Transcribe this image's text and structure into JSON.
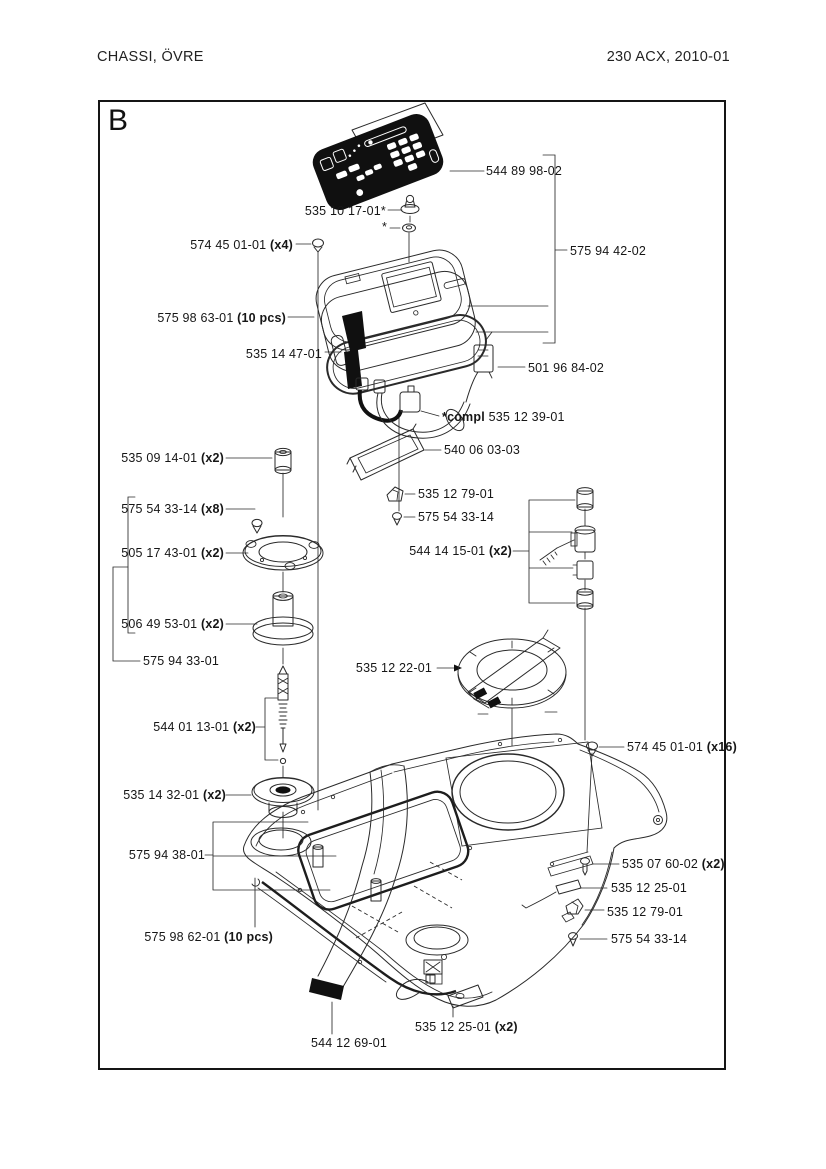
{
  "header": {
    "title": "CHASSI, ÖVRE",
    "model": "230 ACX, 2010-01"
  },
  "section": {
    "letter": "B"
  },
  "parts": [
    {
      "number": "544 89 98-02"
    },
    {
      "number": "535 10 17-01*"
    },
    {
      "number": "*"
    },
    {
      "number": "574 45 01-01",
      "qty": " (x4)"
    },
    {
      "number": "575 94 42-02"
    },
    {
      "number": "575 98 63-01",
      "qty": " (10 pcs)"
    },
    {
      "number": "535 14 47-01"
    },
    {
      "number": "501 96 84-02"
    },
    {
      "prefix": "*compl ",
      "number": "535 12 39-01"
    },
    {
      "number": "540 06 03-03"
    },
    {
      "number": "535 09 14-01",
      "qty": " (x2)"
    },
    {
      "number": "575 54 33-14",
      "qty": " (x8)"
    },
    {
      "number": "505 17 43-01",
      "qty": " (x2)"
    },
    {
      "number": "506 49 53-01",
      "qty": " (x2)"
    },
    {
      "number": "575 94 33-01"
    },
    {
      "number": "535 12 79-01"
    },
    {
      "number": "575 54 33-14"
    },
    {
      "number": "544 14 15-01",
      "qty": " (x2)"
    },
    {
      "number": "535 12 22-01"
    },
    {
      "number": "544 01 13-01",
      "qty": " (x2)"
    },
    {
      "number": "535 14 32-01",
      "qty": " (x2)"
    },
    {
      "number": "575 94 38-01"
    },
    {
      "number": "574 45 01-01",
      "qty": " (x16)"
    },
    {
      "number": "535 07 60-02",
      "qty": " (x2)"
    },
    {
      "number": "535 12 25-01"
    },
    {
      "number": "535 12 79-01"
    },
    {
      "number": "575 54 33-14"
    },
    {
      "number": "575 98 62-01",
      "qty": " (10 pcs)"
    },
    {
      "number": "535 12 25-01",
      "qty": " (x2)"
    },
    {
      "number": "544 12 69-01"
    }
  ]
}
